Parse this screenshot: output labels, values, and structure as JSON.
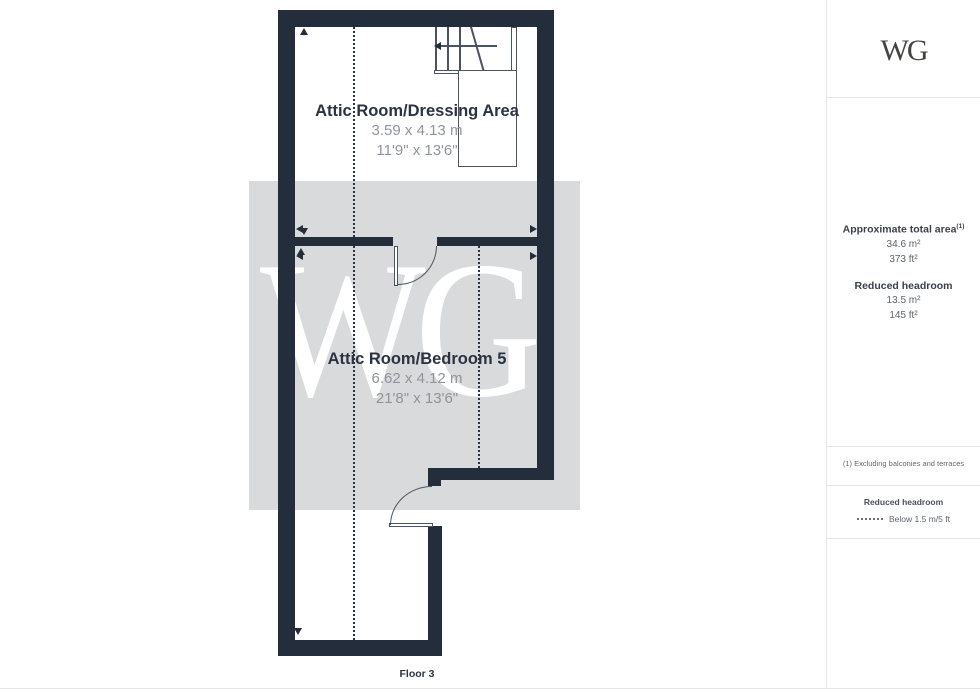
{
  "plan": {
    "floor_label": "Floor 3",
    "watermark": "WG",
    "rooms": [
      {
        "name": "Attic Room/Dressing Area",
        "metric": "3.59 x 4.13 m",
        "imperial": "11'9\" x 13'6\""
      },
      {
        "name": "Attic Room/Bedroom 5",
        "metric": "6.62 x 4.12 m",
        "imperial": "21'8\" x 13'6\""
      }
    ],
    "colors": {
      "wall": "#242d3b",
      "watermark_band": "#d9dadb",
      "room_title": "#2b3342",
      "room_dims": "#8f949c"
    }
  },
  "sidebar": {
    "logo": "WG",
    "area": {
      "title": "Approximate total area",
      "title_sup": "(1)",
      "total_m2": "34.6 m²",
      "total_ft2": "373 ft²",
      "reduced_title": "Reduced headroom",
      "reduced_m2": "13.5 m²",
      "reduced_ft2": "145 ft²"
    },
    "footnote": "(1) Excluding balconies and terraces",
    "legend": {
      "title": "Reduced headroom",
      "label": "Below 1.5 m/5 ft"
    },
    "disclaimer_1": "While every attempt has been made to ensure accuracy, all measurements are approximate, not to scale. This floor plan is for illustrative purposes only.",
    "disclaimer_2": "Calculations were based on RICS IPMS 3C standard. Please note that calculations were adjusted by a third party and therefore may not comply with RICS IPMS 3C.",
    "brand": {
      "name": "GIRAFFE",
      "suffix": "360"
    }
  }
}
